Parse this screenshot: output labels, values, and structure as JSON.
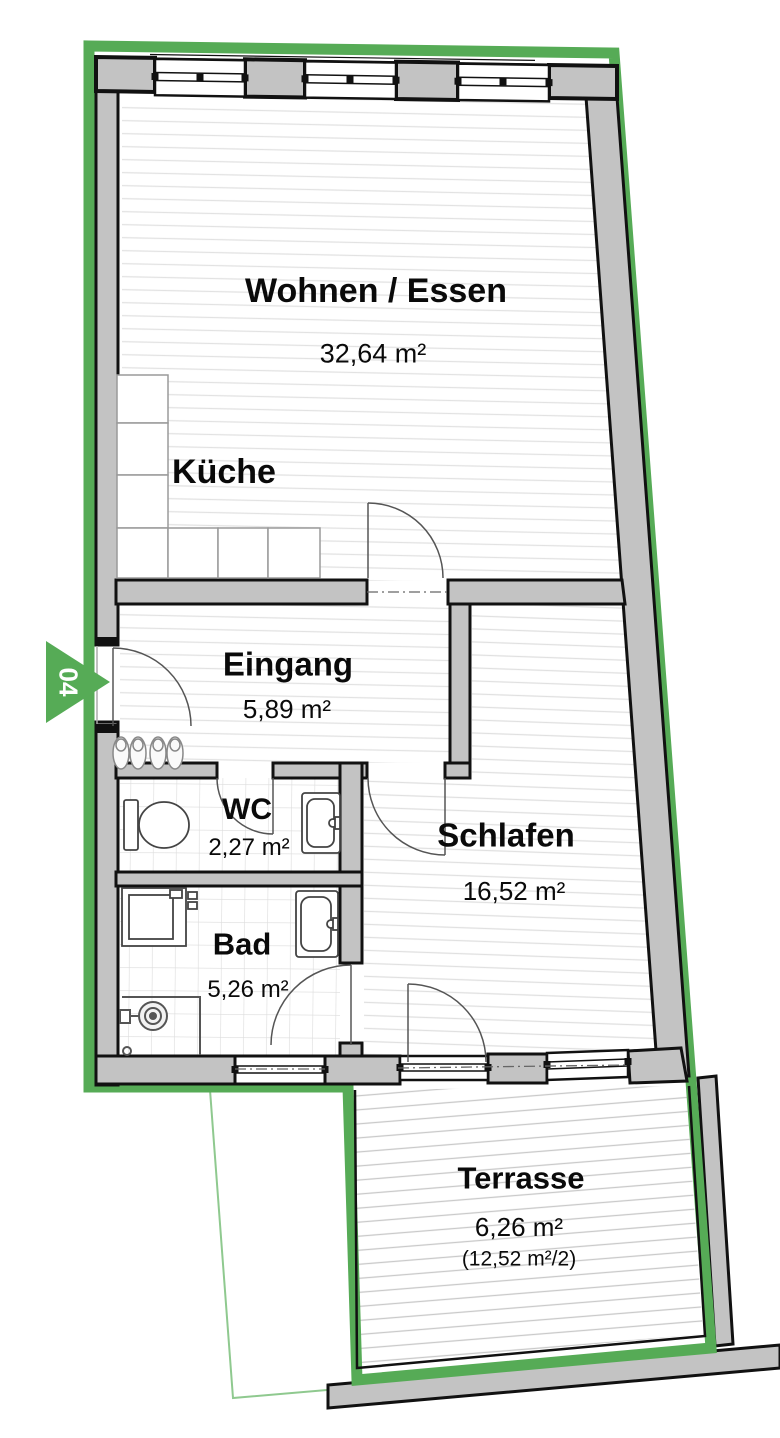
{
  "plan": {
    "unit_marker": "04",
    "rooms": [
      {
        "name": "Wohnen / Essen",
        "area": "32,64 m²"
      },
      {
        "name": "Küche"
      },
      {
        "name": "Eingang",
        "area": "5,89 m²"
      },
      {
        "name": "WC",
        "area": "2,27 m²"
      },
      {
        "name": "Bad",
        "area": "5,26 m²"
      },
      {
        "name": "Schlafen",
        "area": "16,52 m²"
      },
      {
        "name": "Terrasse",
        "area": "6,26 m²",
        "area_note": "(12,52 m²/2)"
      }
    ],
    "colors": {
      "unit_border": "#56ab56",
      "property_line": "#8fc98f",
      "wall_fill": "#c3c3c3",
      "wall_outline": "#111111",
      "floor_line": "#e2e2e2",
      "tile_line": "#dcdcdc",
      "deck_line": "#c9c9c9",
      "label_text": "#0a0a0a",
      "marker_text": "#ffffff"
    }
  }
}
